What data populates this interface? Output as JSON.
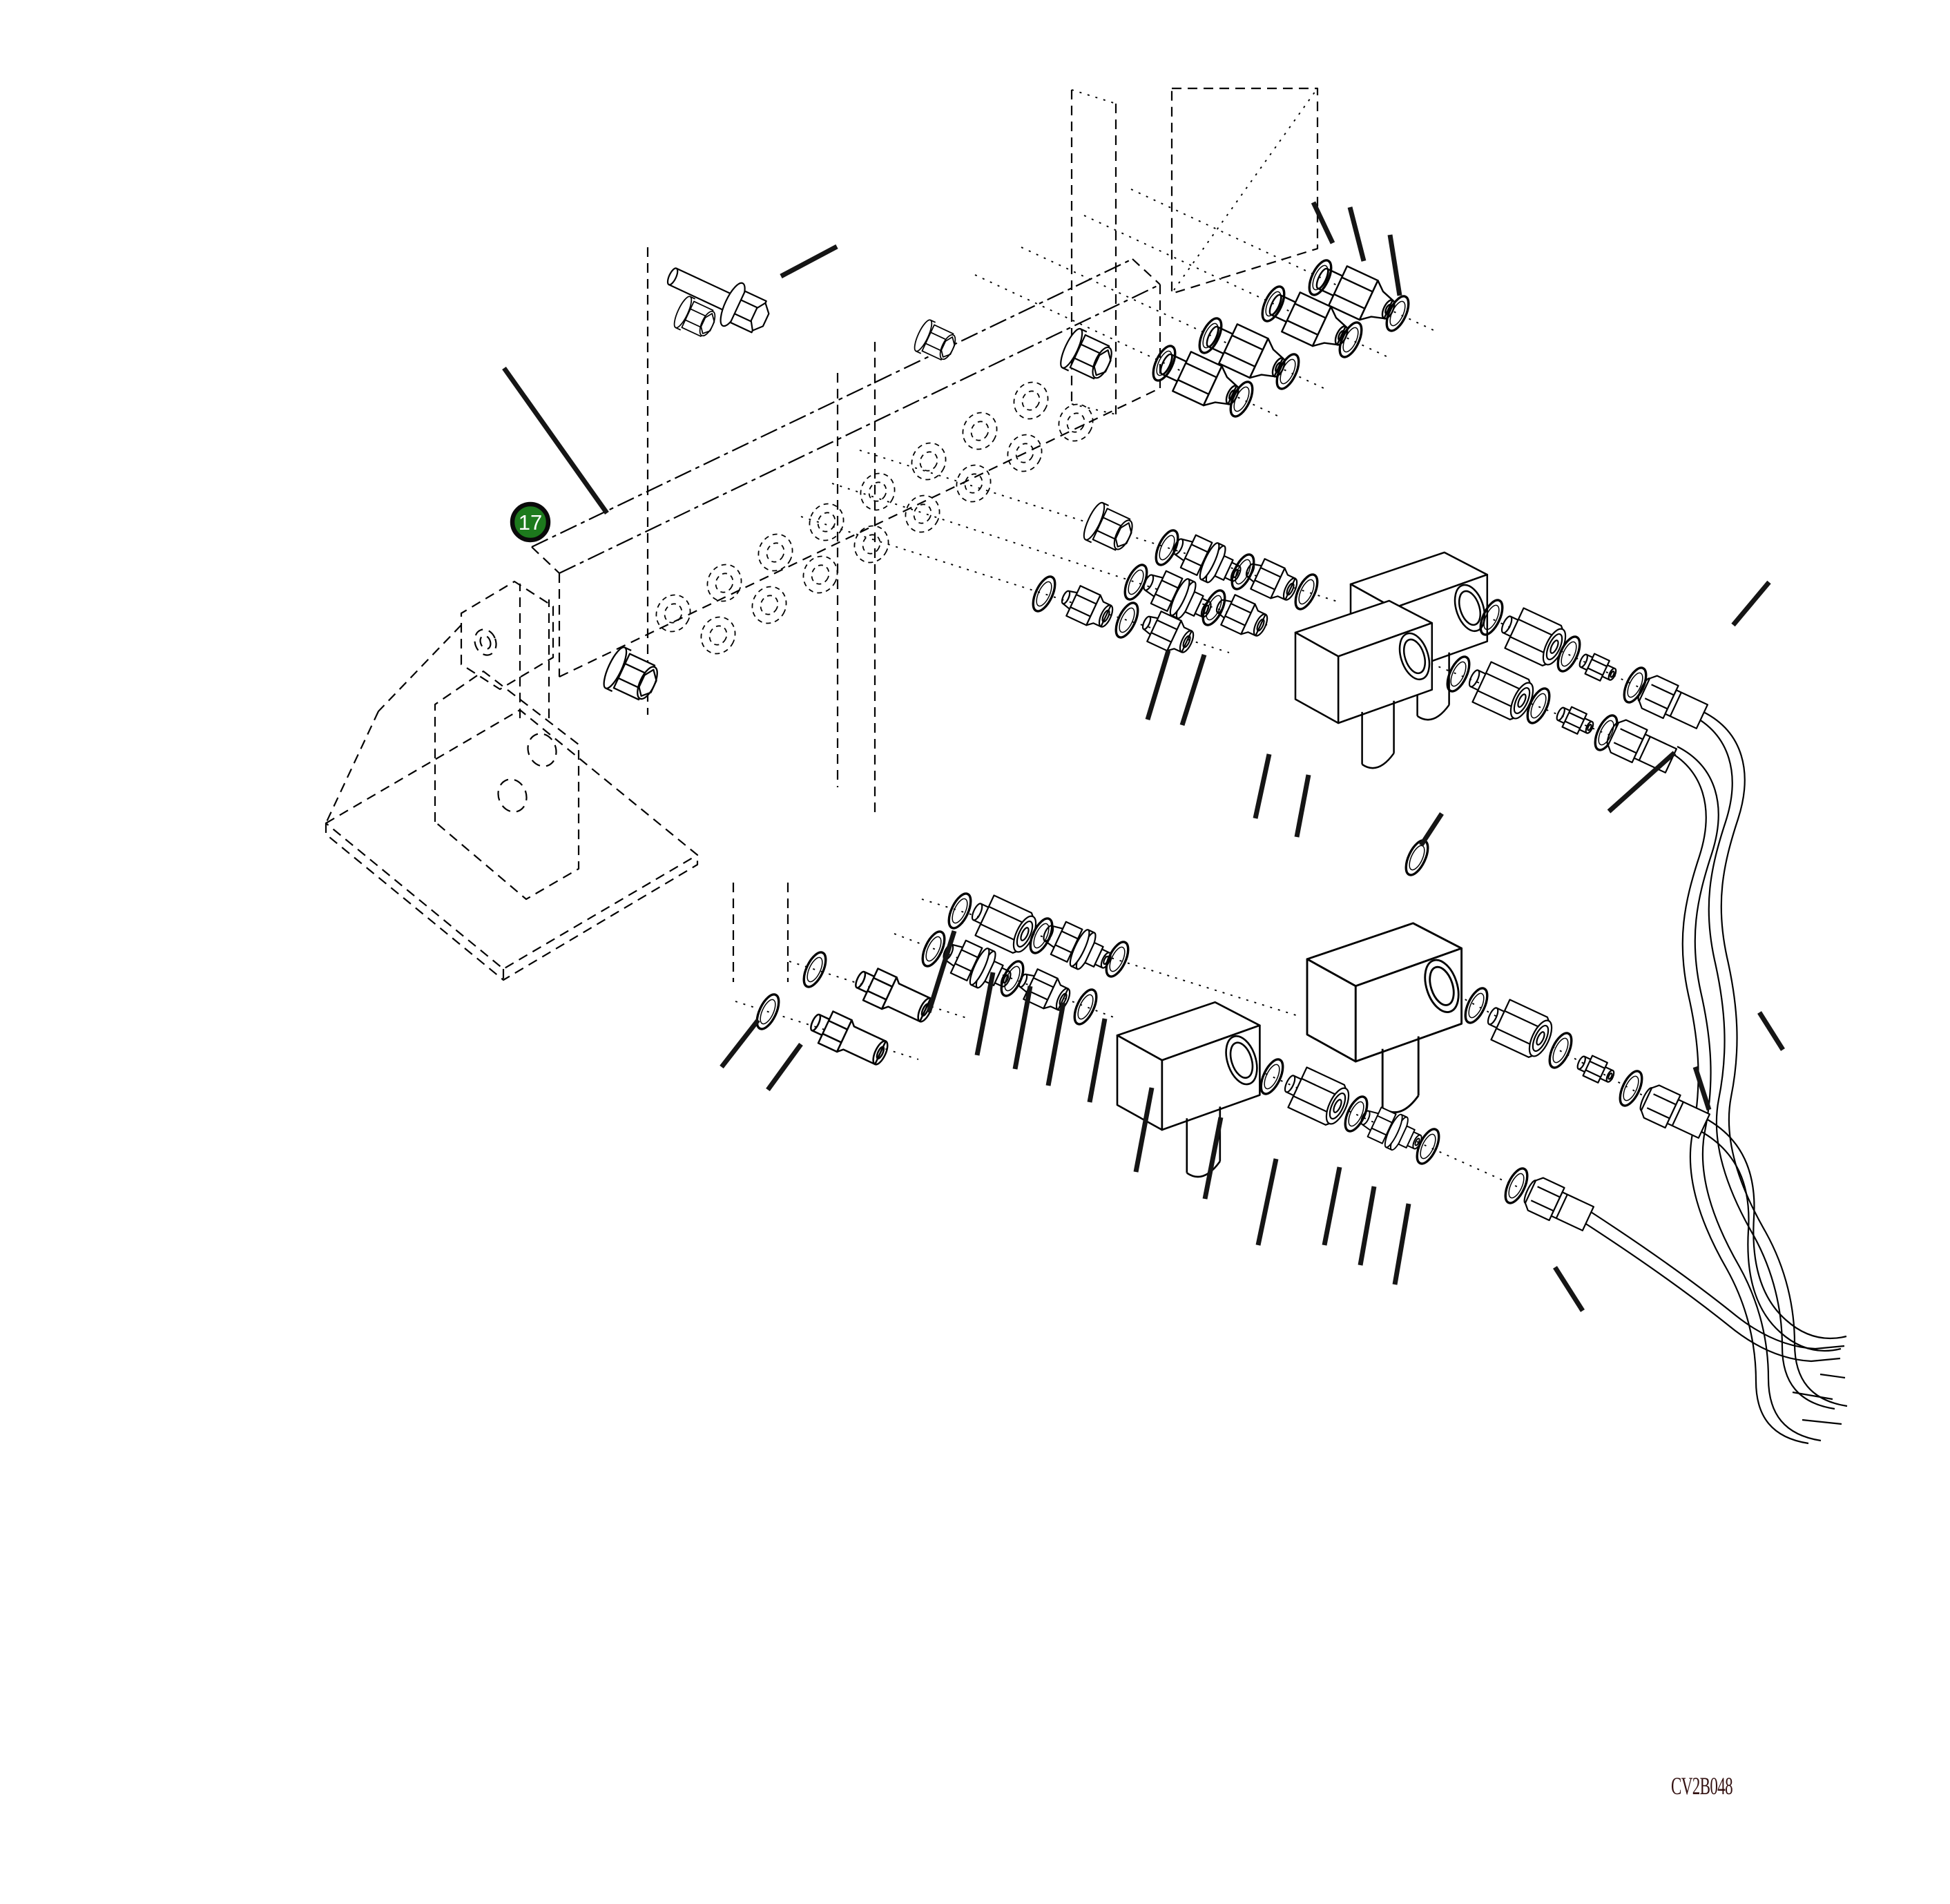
{
  "diagram": {
    "kind": "exploded-parts-diagram",
    "background": "#ffffff",
    "line_color": "#000000",
    "leader_color": "#151515",
    "callout": {
      "number": "17",
      "fill": "#1d7a1d",
      "ring_color": "#0a0a0a",
      "text_color": "#ffffff"
    },
    "drawing_code": {
      "text": "CV2B048",
      "color": "#331111"
    }
  }
}
